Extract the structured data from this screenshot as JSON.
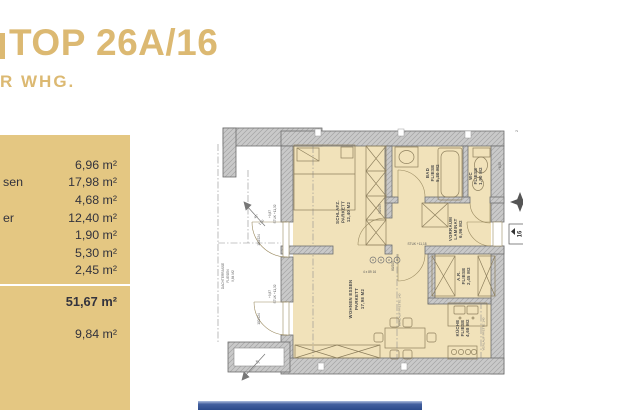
{
  "header": {
    "title": "TOP 26A/16",
    "subtitle": "R WHG.",
    "accent_color": "#dcb972"
  },
  "panel": {
    "bg_color": "#e4c782",
    "rows": [
      {
        "label": "",
        "area": "6,96 m²"
      },
      {
        "label": "sen",
        "area": "17,98 m²"
      },
      {
        "label": "",
        "area": "4,68 m²"
      },
      {
        "label": "er",
        "area": "12,40 m²"
      },
      {
        "label": "",
        "area": "1,90 m²"
      },
      {
        "label": "",
        "area": "5,30 m²"
      },
      {
        "label": "",
        "area": "2,45 m²"
      }
    ],
    "total_area": "51,67 m²",
    "terrace_area": "9,84 m²"
  },
  "plan": {
    "rooms": {
      "schlaf": {
        "name": "SCHLAFZ.",
        "floor": "PARKETT",
        "area": "12,40 M2"
      },
      "bad": {
        "name": "BAD",
        "floor": "FLIESE",
        "area": "5,30 M2"
      },
      "wc": {
        "name": "WC",
        "floor": "FLIESE",
        "area": "1,90 M2"
      },
      "vorraum": {
        "name": "VORRAUM",
        "floor": "LAMINAT",
        "area": "6,96 M2"
      },
      "ar": {
        "name": "A.R.",
        "floor": "FLIESE",
        "area": "2,45 M2"
      },
      "kueche": {
        "name": "KÜCHE",
        "floor": "FLIESE",
        "area": "4,68 M2"
      },
      "wohnen": {
        "name": "WOHNEN ESSEN",
        "floor": "PARKETT",
        "area": "17,98 M2"
      },
      "terrasse": {
        "name": "DACHTERRASSE",
        "floor": "FLIESEN",
        "area": "9,84 M2"
      }
    },
    "annotations": {
      "steps": "4 x 89 16",
      "purlin1": "VERLAUF PFETTE 140",
      "purlin2": "VERLAUF PFETTE 140",
      "door_terrace_1": "100/224",
      "door_terrace_2": "100/224",
      "door_schlaf": "90/205",
      "door_vorraum": "80/205",
      "level_stuk_1": "STUK +11,32",
      "level_1": "+9,87",
      "level_stuk_2": "STUK +11,32",
      "level_2": "+9,87",
      "level_stuk_3": "STUK +11,18",
      "level_3": "+8,50",
      "slope_angle": "45°",
      "slope_len": "1,50",
      "unit_number": "16",
      "axis_number": "2"
    }
  },
  "footer": {
    "bar_color": "#2c4a8b"
  }
}
